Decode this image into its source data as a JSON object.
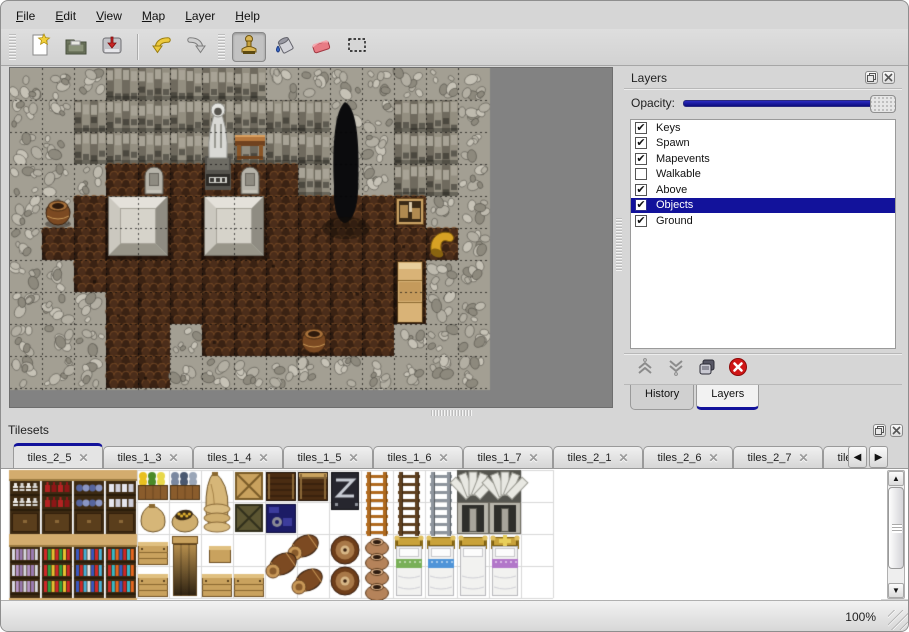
{
  "colors": {
    "selection_navy": "#12129b",
    "slider_navy": "#10108c",
    "canvas_gray": "#828282"
  },
  "menu": {
    "items": [
      "File",
      "Edit",
      "View",
      "Map",
      "Layer",
      "Help"
    ]
  },
  "toolbar": {
    "groups": [
      {
        "tools": [
          {
            "name": "new-file"
          },
          {
            "name": "open"
          },
          {
            "name": "save"
          }
        ]
      },
      {
        "tools": [
          {
            "name": "undo"
          },
          {
            "name": "redo"
          }
        ]
      },
      {
        "tools": [
          {
            "name": "stamp",
            "active": true
          },
          {
            "name": "fill"
          },
          {
            "name": "eraser"
          },
          {
            "name": "rect-select"
          }
        ]
      }
    ]
  },
  "layers_panel": {
    "title": "Layers",
    "window_buttons": [
      "float",
      "close"
    ],
    "opacity_label": "Opacity:",
    "opacity_value": 1.0,
    "layers": [
      {
        "name": "Keys",
        "checked": true
      },
      {
        "name": "Spawn",
        "checked": true
      },
      {
        "name": "Mapevents",
        "checked": true
      },
      {
        "name": "Walkable",
        "checked": false
      },
      {
        "name": "Above",
        "checked": true
      },
      {
        "name": "Objects",
        "checked": true,
        "selected": true
      },
      {
        "name": "Ground",
        "checked": true
      }
    ],
    "buttons": [
      {
        "name": "move-up"
      },
      {
        "name": "move-down"
      },
      {
        "name": "duplicate"
      },
      {
        "name": "delete"
      }
    ],
    "tabs": [
      {
        "label": "History",
        "active": false
      },
      {
        "label": "Layers",
        "active": true
      }
    ]
  },
  "tilesets_panel": {
    "title": "Tilesets",
    "window_buttons": [
      "float",
      "close"
    ],
    "tabs": [
      {
        "label": "tiles_2_5",
        "active": true
      },
      {
        "label": "tiles_1_3"
      },
      {
        "label": "tiles_1_4"
      },
      {
        "label": "tiles_1_5"
      },
      {
        "label": "tiles_1_6"
      },
      {
        "label": "tiles_1_7"
      },
      {
        "label": "tiles_2_1"
      },
      {
        "label": "tiles_2_6"
      },
      {
        "label": "tiles_2_7"
      },
      {
        "label": "tiles_3_1",
        "partial": true
      }
    ],
    "scroll_buttons": [
      "left",
      "right"
    ]
  },
  "status_bar": {
    "zoom": "100%"
  },
  "map": {
    "tile_size": 32,
    "grid": [
      "WWWRRRRRWWWWWWW",
      "WWRRRRRRRRWWRRW",
      "WWRRRRRRRRWWRRW",
      "WWWFFFFFFRWWRRW",
      "WWFFFFFFFFFFFWW",
      "WFFFFFFFFFFFFFW",
      "WWFFFFFFFFFFFWW",
      "WWWFFFFFFFFFFWW",
      "WWWFFWFFFFFFWWW",
      "WWWFFWWWWWWWWWW",
      "WWWWWWWWWWWWWWW"
    ],
    "objects": [
      [
        "statue",
        6,
        1
      ],
      [
        "table",
        7,
        2
      ],
      [
        "cave",
        10,
        1
      ],
      [
        "grave",
        4,
        3
      ],
      [
        "grave",
        7,
        3
      ],
      [
        "platform",
        3,
        4
      ],
      [
        "platform",
        6,
        4
      ],
      [
        "barrel",
        1,
        4
      ],
      [
        "crate",
        12,
        4
      ],
      [
        "jug",
        13,
        5
      ],
      [
        "cabinet",
        12,
        6
      ],
      [
        "barrel",
        9,
        8
      ]
    ]
  },
  "tileset_tiles": {
    "tile_size": 32,
    "items": [
      [
        "shelf",
        0,
        0,
        "dishes"
      ],
      [
        "shelf",
        1,
        0,
        "redbottles"
      ],
      [
        "shelf",
        2,
        0,
        "bluepots"
      ],
      [
        "shelf",
        3,
        0,
        "jars"
      ],
      [
        "planter",
        4,
        0,
        "flowers"
      ],
      [
        "planter",
        5,
        0,
        "catch"
      ],
      [
        "sacktall",
        6,
        0,
        ""
      ],
      [
        "cratex",
        7,
        0,
        "light"
      ],
      [
        "plankchest",
        8,
        0,
        "dark"
      ],
      [
        "plankchest",
        9,
        0,
        "banded"
      ],
      [
        "metalchest",
        10,
        0,
        ""
      ],
      [
        "ladder",
        11,
        0,
        "#b06a1e"
      ],
      [
        "ladder",
        12,
        0,
        "#5e4020"
      ],
      [
        "ladder",
        13,
        0,
        "#8e959d"
      ],
      [
        "arch",
        14,
        0,
        ""
      ],
      [
        "arch",
        15,
        0,
        ""
      ],
      [
        "sack",
        4,
        1,
        ""
      ],
      [
        "sackopen",
        5,
        1,
        ""
      ],
      [
        "sacksflat",
        6,
        1,
        ""
      ],
      [
        "cratex",
        7,
        1,
        "dark"
      ],
      [
        "bluecrate",
        8,
        1,
        ""
      ],
      [
        "shelf2",
        0,
        2,
        "b1"
      ],
      [
        "shelf2",
        1,
        2,
        "b2"
      ],
      [
        "shelf2",
        2,
        2,
        "b3"
      ],
      [
        "shelf2",
        3,
        2,
        "b4"
      ],
      [
        "woodbox",
        4,
        2,
        ""
      ],
      [
        "woodbox",
        4,
        3,
        ""
      ],
      [
        "tallcrate",
        5,
        2,
        ""
      ],
      [
        "smallbox",
        6,
        2,
        ""
      ],
      [
        "woodbox",
        6,
        3,
        ""
      ],
      [
        "woodbox",
        7,
        3,
        ""
      ],
      [
        "barrelcluster",
        8,
        2,
        ""
      ],
      [
        "barrelstack",
        10,
        2,
        ""
      ],
      [
        "potstack",
        11,
        2,
        ""
      ],
      [
        "bed",
        12,
        2,
        "#79b058"
      ],
      [
        "bed",
        13,
        2,
        "#4f94d8"
      ],
      [
        "bed",
        14,
        2,
        "none"
      ],
      [
        "bed",
        15,
        2,
        "#b277c9"
      ]
    ]
  }
}
